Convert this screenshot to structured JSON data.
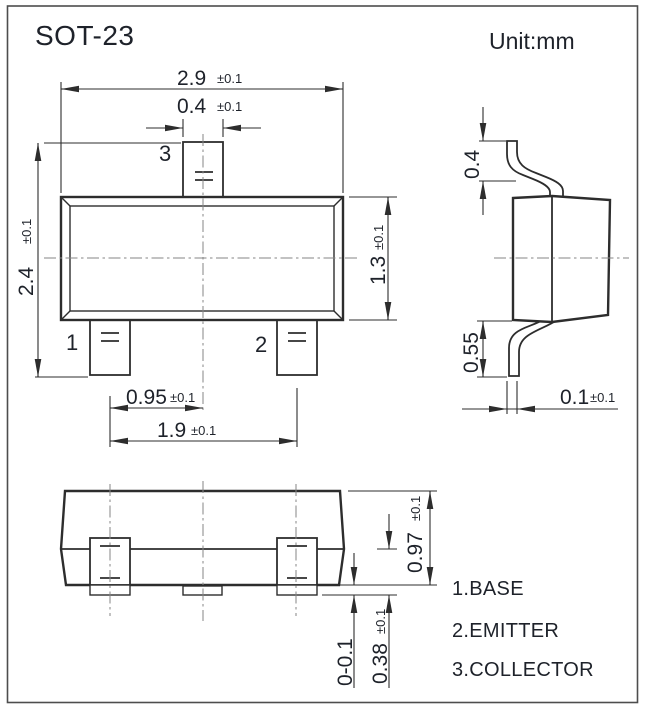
{
  "title": "SOT-23",
  "unit_label": "Unit:mm",
  "colors": {
    "line": "#2d2d2d",
    "text": "#1e222a",
    "centerline": "#868686"
  },
  "top_view": {
    "dim_body_width": {
      "value": "2.9",
      "tol": "±0.1"
    },
    "dim_pin_width": {
      "value": "0.4",
      "tol": "±0.1"
    },
    "dim_total_height": {
      "value": "2.4",
      "tol": "±0.1"
    },
    "dim_body_height": {
      "value": "1.3",
      "tol": "±0.1"
    },
    "dim_pin_pitch": {
      "value": "0.95",
      "tol": "±0.1"
    },
    "dim_pin_span": {
      "value": "1.9",
      "tol": "±0.1"
    },
    "pin_labels": {
      "pin1": "1",
      "pin2": "2",
      "pin3": "3"
    }
  },
  "side_view": {
    "dim_lead_top": "0.4",
    "dim_lead_bottom": "0.55",
    "dim_lead_thickness": {
      "value": "0.1",
      "tol": "±0.1"
    }
  },
  "front_view": {
    "dim_body_height": {
      "value": "0.97",
      "tol": "±0.1"
    },
    "dim_standoff": "0-0.1",
    "dim_lead_height": {
      "value": "0.38",
      "tol": "±0.1"
    }
  },
  "legend": {
    "pin1": "1.BASE",
    "pin2": "2.EMITTER",
    "pin3": "3.COLLECTOR"
  }
}
